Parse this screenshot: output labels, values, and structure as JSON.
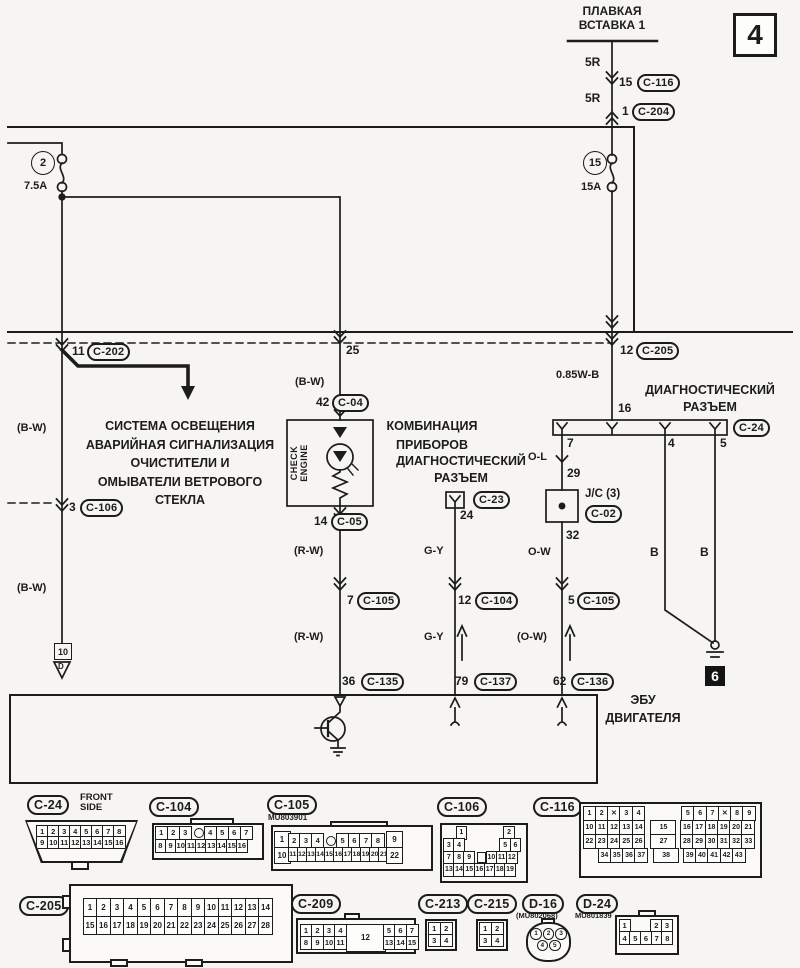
{
  "sheet": {
    "number": "4",
    "ground_id": "6",
    "page_ref_num": "10",
    "page_ref_letter": "D"
  },
  "power": {
    "fusible_link": "ПЛАВКАЯ\nВСТАВКА 1",
    "wire_5r_a": "5R",
    "wire_5r_b": "5R",
    "c116_pin": "15",
    "c116": "C-116",
    "c204_pin": "1",
    "c204": "C-204",
    "fuse_left_no": "2",
    "fuse_left_amp": "7.5A",
    "fuse_right_no": "15",
    "fuse_right_amp": "15A"
  },
  "branch_left": {
    "pin": "11",
    "conn": "C-202",
    "wire_a": "(B-W)",
    "pin2": "3",
    "conn2": "C-106",
    "wire_b": "(B-W)",
    "dest": "СИСТЕМА ОСВЕЩЕНИЯ\nАВАРИЙНАЯ СИГНАЛИЗАЦИЯ\nОЧИСТИТЕЛИ И\nОМЫВАТЕЛИ ВЕТРОВОГО\nСТЕКЛА"
  },
  "meter": {
    "bus_pin": "25",
    "wire_a": "(B-W)",
    "pin_in": "42",
    "conn_in": "C-04",
    "name": "КОМБИНАЦИЯ\nПРИБОРОВ",
    "lamp": "CHECK\nENGINE",
    "pin_out": "14",
    "conn_out": "C-05",
    "wire_b": "(R-W)",
    "mid_pin": "7",
    "mid_conn": "C-105",
    "wire_c": "(R-W)",
    "ecu_pin": "36",
    "ecu_conn": "C-135"
  },
  "diag_c23": {
    "title": "ДИАГНОСТИЧЕСКИЙ\nРАЗЪЕМ",
    "conn": "C-23",
    "pin": "24",
    "wire_a": "G-Y",
    "mid_pin": "12",
    "mid_conn": "C-104",
    "wire_b": "G-Y",
    "ecu_pin": "79",
    "ecu_conn": "C-137"
  },
  "diag_c24": {
    "title": "ДИАГНОСТИЧЕСКИЙ\nРАЗЪЕМ",
    "conn": "C-24",
    "feed_pin": "12",
    "feed_conn": "C-205",
    "feed_wire": "0.85W-B",
    "pin_16": "16",
    "pin_7": "7",
    "pin_4": "4",
    "pin_5": "5",
    "wire_ol": "O-L",
    "jc_pin_in": "29",
    "jc_name": "J/C (3)",
    "jc_conn": "C-02",
    "jc_pin_out": "32",
    "wire_ow": "O-W",
    "mid_pin": "5",
    "mid_conn": "C-105",
    "wire_ow2": "(O-W)",
    "ecu_pin": "62",
    "ecu_conn": "C-136",
    "gnd_wire_a": "B",
    "gnd_wire_b": "B"
  },
  "ecu": {
    "name": "ЭБУ\nДВИГАТЕЛЯ"
  },
  "connectors": {
    "c24": {
      "label": "C-24",
      "note": "FRONT\nSIDE",
      "row1": [
        "1",
        "2",
        "3",
        "4",
        "5",
        "6",
        "7",
        "8"
      ],
      "row2": [
        "9",
        "10",
        "11",
        "12",
        "13",
        "14",
        "15",
        "16"
      ]
    },
    "c104": {
      "label": "C-104",
      "row1a": [
        "1",
        "2",
        "3"
      ],
      "row1b": [
        "4",
        "5",
        "6",
        "7"
      ],
      "row2": [
        "8",
        "9",
        "10",
        "11",
        "12",
        "13",
        "14",
        "15",
        "16"
      ]
    },
    "c105": {
      "label": "C-105",
      "code": "MU803901",
      "tl": "1",
      "tr": "9",
      "bl": "10",
      "br": "22",
      "row1a": [
        "2",
        "3",
        "4"
      ],
      "row1b": [
        "5",
        "6",
        "7",
        "8"
      ],
      "row2": [
        "11",
        "12",
        "13",
        "14",
        "15",
        "16",
        "17",
        "18",
        "19",
        "20",
        "21"
      ]
    },
    "c106": {
      "label": "C-106",
      "row1": [
        "1",
        "2"
      ],
      "row2a": [
        "3",
        "4"
      ],
      "row2b": [
        "5",
        "6"
      ],
      "row3a": [
        "7",
        "8",
        "9"
      ],
      "row3b": [
        "10",
        "11",
        "12"
      ],
      "row4": [
        "13",
        "14",
        "15",
        "16",
        "17",
        "18",
        "19"
      ]
    },
    "c116": {
      "label": "C-116",
      "row1": [
        "1",
        "2",
        "✕",
        "3",
        "4",
        "5",
        "6",
        "7",
        "✕",
        "8",
        "9"
      ],
      "row2": [
        "10",
        "11",
        "12",
        "13",
        "14",
        "15",
        "16",
        "17",
        "18",
        "19",
        "20",
        "21"
      ],
      "row3": [
        "22",
        "23",
        "24",
        "25",
        "26",
        "27",
        "28",
        "29",
        "30",
        "31",
        "32",
        "33"
      ],
      "row4": [
        "34",
        "35",
        "36",
        "37",
        "38",
        "39",
        "40",
        "41",
        "42",
        "43"
      ]
    },
    "c205": {
      "label": "C-205",
      "row1": [
        "1",
        "2",
        "3",
        "4",
        "5",
        "6",
        "7",
        "8",
        "9",
        "10",
        "11",
        "12",
        "13",
        "14"
      ],
      "row2": [
        "15",
        "16",
        "17",
        "18",
        "19",
        "20",
        "21",
        "22",
        "23",
        "24",
        "25",
        "26",
        "27",
        "28"
      ]
    },
    "c209": {
      "label": "C-209",
      "left_top": [
        "1",
        "2",
        "3",
        "4"
      ],
      "left_bottom": [
        "8",
        "9",
        "10",
        "11"
      ],
      "middle": "12",
      "right_top": [
        "5",
        "6",
        "7"
      ],
      "right_bottom": [
        "13",
        "14",
        "15"
      ]
    },
    "c213": {
      "label": "C-213",
      "row1": [
        "1",
        "2"
      ],
      "row2": [
        "3",
        "4"
      ]
    },
    "c215": {
      "label": "C-215",
      "row1": [
        "1",
        "2"
      ],
      "row2": [
        "3",
        "4"
      ]
    },
    "d16": {
      "label": "D-16",
      "code": "(MU802068)",
      "row1": [
        "1",
        "2",
        "3"
      ],
      "row2": [
        "4",
        "5"
      ]
    },
    "d24": {
      "label": "D-24",
      "code": "MU801839",
      "row1a": [
        "1"
      ],
      "row1b": [
        "2",
        "3"
      ],
      "row2": [
        "4",
        "5",
        "6",
        "7",
        "8"
      ]
    }
  },
  "colors": {
    "line": "#1c1c1c",
    "background": "#f6f5f1"
  }
}
